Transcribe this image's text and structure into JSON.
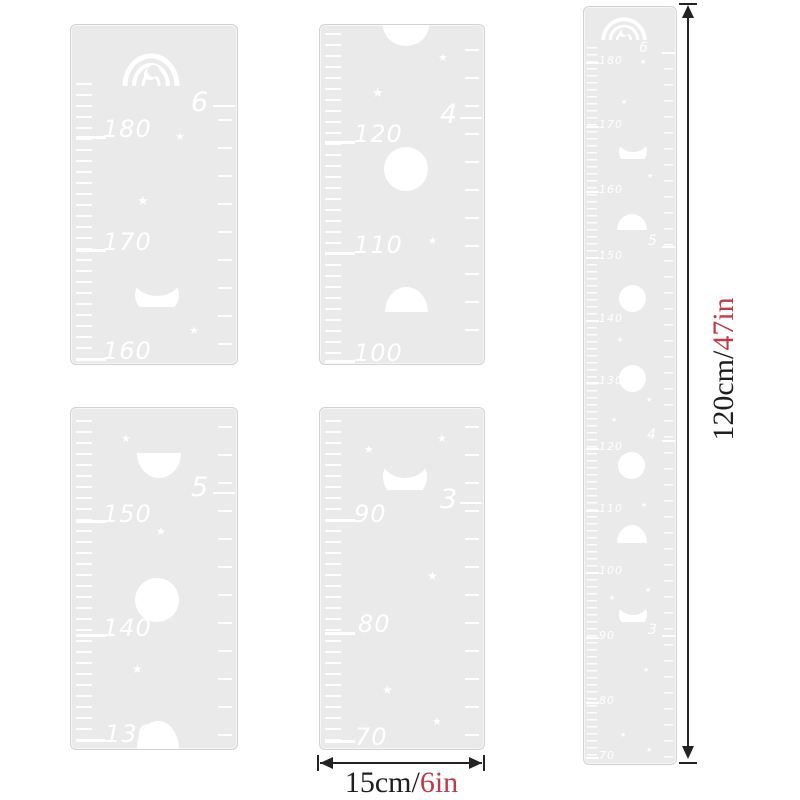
{
  "segments": [
    {
      "foot_label": "6",
      "numbers": [
        "180",
        "170",
        "160"
      ]
    },
    {
      "foot_label": "4",
      "numbers": [
        "120",
        "110",
        "100"
      ]
    },
    {
      "foot_label": "5",
      "numbers": [
        "150",
        "140",
        "130"
      ]
    },
    {
      "foot_label": "3",
      "numbers": [
        "90",
        "80",
        "70"
      ]
    }
  ],
  "full_ruler": {
    "foot_labels": [
      "6",
      "5",
      "4",
      "3"
    ],
    "numbers": [
      "180",
      "170",
      "160",
      "150",
      "140",
      "130",
      "120",
      "110",
      "100",
      "90",
      "80",
      "70"
    ]
  },
  "dimensions": {
    "height_metric": "120cm/",
    "height_imperial": "47in",
    "width_metric": "15cm/",
    "width_imperial": "6in"
  },
  "icons": {
    "star": "★"
  },
  "colors": {
    "panel": "#eaeaea",
    "marking": "#ffffff",
    "dimension_text": "#1e1e1e",
    "dimension_accent": "#c13a45"
  }
}
